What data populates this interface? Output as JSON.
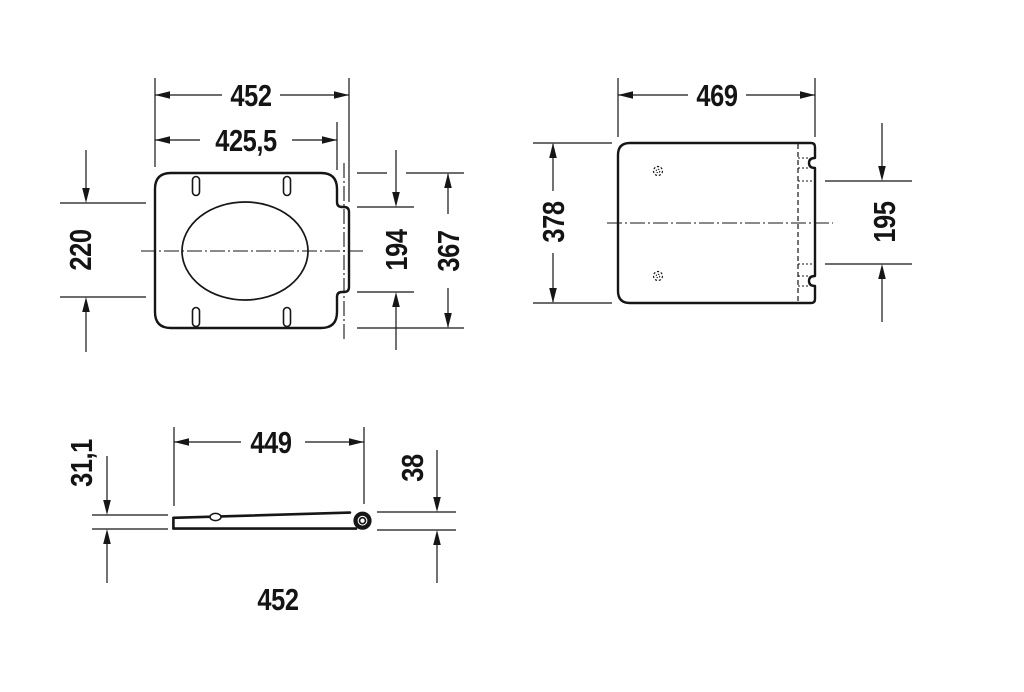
{
  "drawing": {
    "background": "#ffffff",
    "line_color": "#161616",
    "views": {
      "seat_top": {
        "dims": {
          "overall_width": "452",
          "body_width": "425,5",
          "opening_depth": "220",
          "hinge_cutout_width": "194",
          "overall_depth": "367"
        }
      },
      "lid_top": {
        "dims": {
          "overall_width": "469",
          "overall_depth": "378",
          "hinge_cutout_width": "195"
        }
      },
      "side": {
        "dims": {
          "length_to_hinge": "449",
          "front_height": "31,1",
          "hinge_height": "38",
          "overall_length": "452"
        }
      }
    }
  }
}
